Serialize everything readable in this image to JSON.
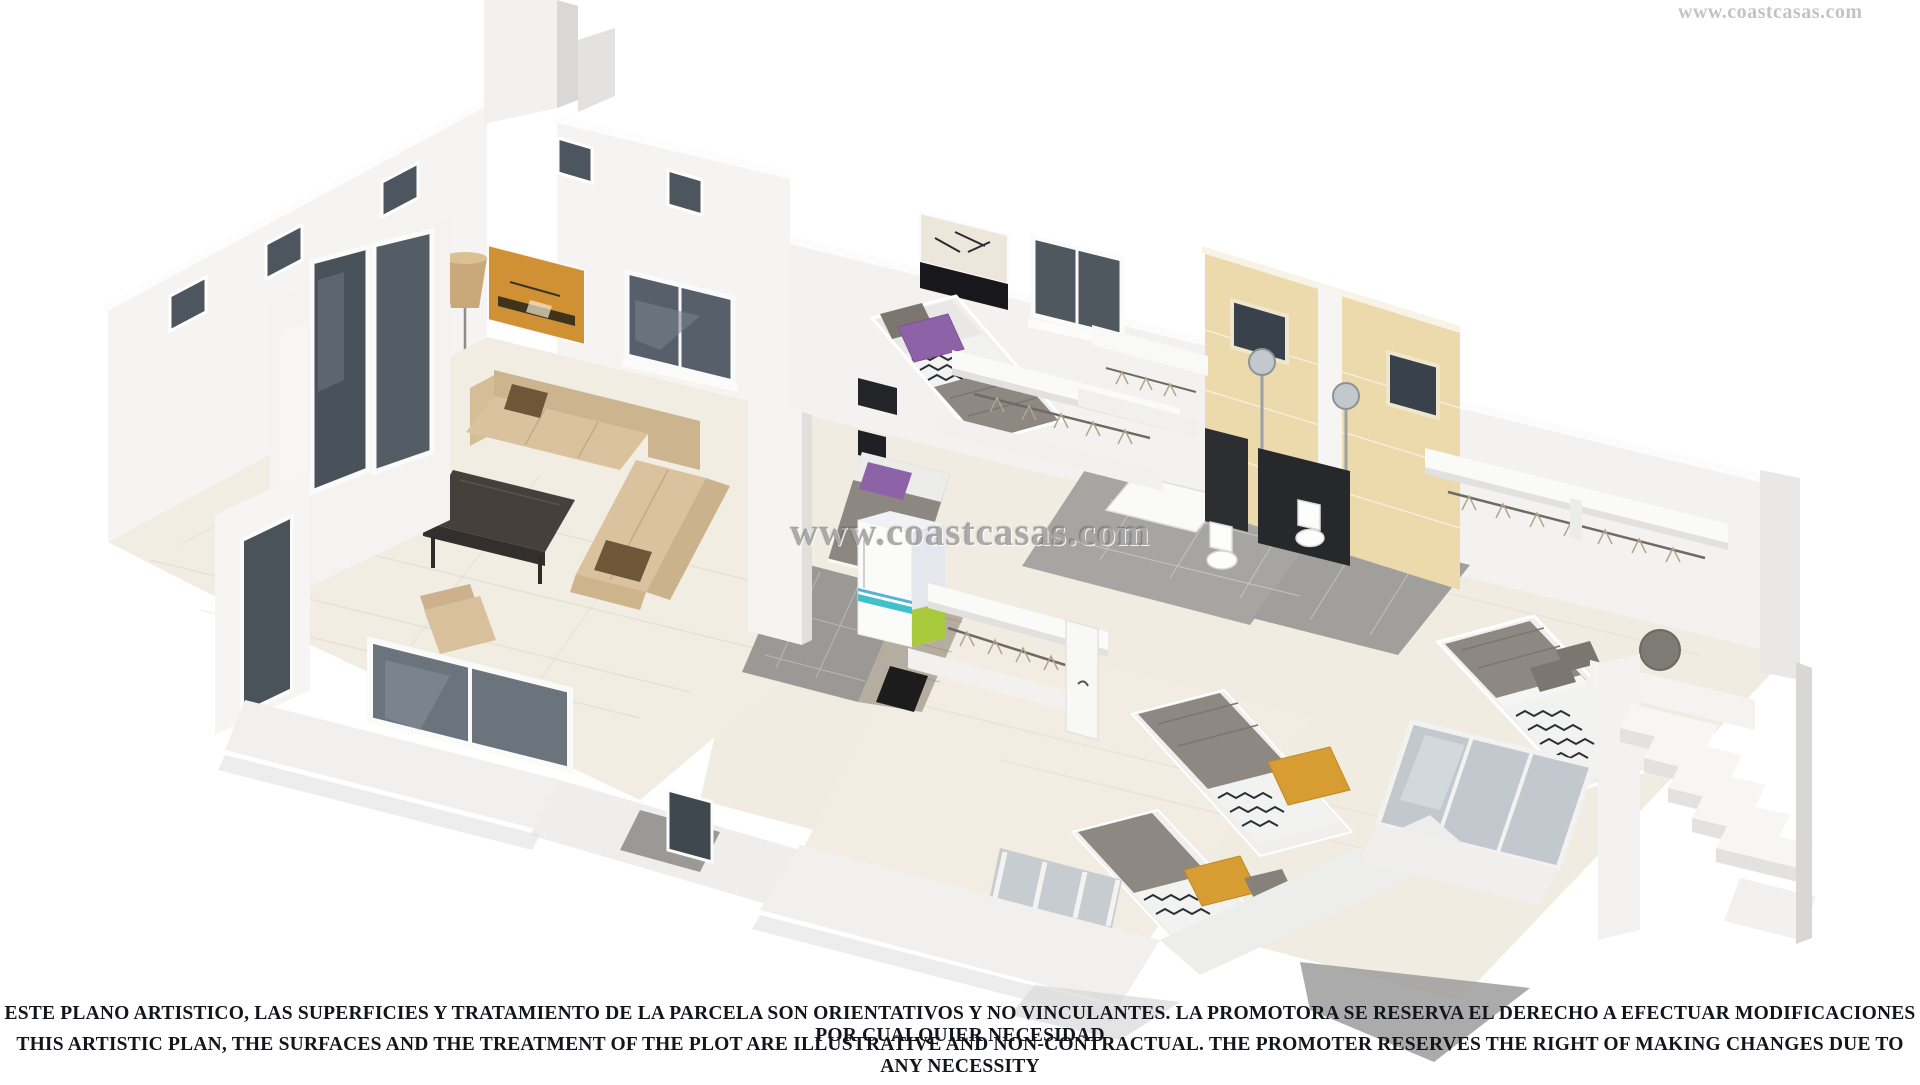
{
  "watermark": {
    "text": "www.coastcasas.com"
  },
  "disclaimer": {
    "line1": "ESTE PLANO ARTISTICO, LAS SUPERFICIES Y TRATAMIENTO DE LA PARCELA SON ORIENTATIVOS Y NO VINCULANTES. LA PROMOTORA SE RESERVA EL DERECHO A EFECTUAR MODIFICACIONES POR CUALQUIER NECESIDAD",
    "line2": "THIS ARTISTIC PLAN, THE SURFACES AND THE TREATMENT OF THE PLOT ARE ILLUSTRATIVE AND NON-CONTRACTUAL. THE PROMOTER RESERVES THE RIGHT OF MAKING CHANGES DUE TO ANY NECESSITY"
  },
  "colors": {
    "wall_white": "#f5f4f2",
    "wall_shade": "#e3e2e0",
    "floor_cream": "#f2ede3",
    "bath_tile_tan": "#ecd9ac",
    "floor_tile_gray": "#a6a5a1",
    "sofa_beige": "#d8c19c",
    "pillow_brown": "#6e5738",
    "table_dark": "#45403c",
    "bed_gray": "#8d8882",
    "pillow_purple": "#8e62a7",
    "pillow_yellow": "#d79d33",
    "stripe_navy": "#2b2e37",
    "fridge_cyan": "#3fc0cb",
    "fridge_green": "#a9ca3c",
    "art_orange": "#d09134",
    "glass_dark": "#4f575f",
    "text_dark": "#14141d",
    "watermark_gray": "#6c6c6c"
  }
}
